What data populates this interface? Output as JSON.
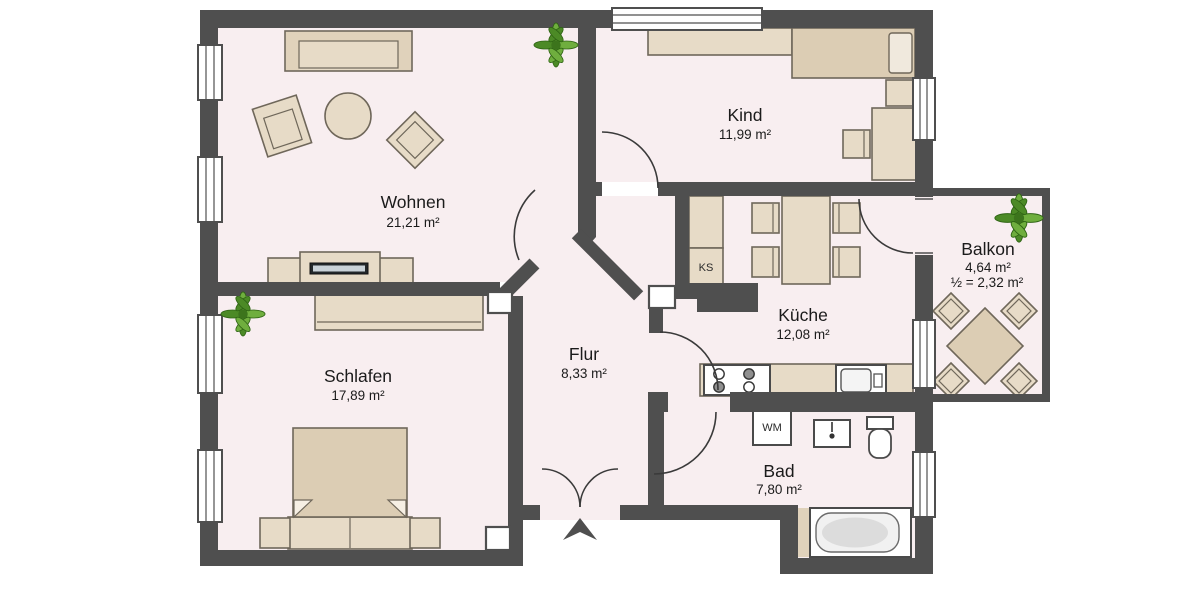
{
  "rooms": [
    {
      "id": "wohnen",
      "name": "Wohnen",
      "area": "21,21 m²"
    },
    {
      "id": "kind",
      "name": "Kind",
      "area": "11,99 m²"
    },
    {
      "id": "schlafen",
      "name": "Schlafen",
      "area": "17,89 m²"
    },
    {
      "id": "flur",
      "name": "Flur",
      "area": "8,33 m²"
    },
    {
      "id": "kueche",
      "name": "Küche",
      "area": "12,08 m²"
    },
    {
      "id": "bad",
      "name": "Bad",
      "area": "7,80 m²"
    },
    {
      "id": "balkon",
      "name": "Balkon",
      "area": "4,64 m²",
      "area_half": "½ = 2,32 m²"
    }
  ],
  "labels": {
    "fridge": "KS",
    "washing_machine": "WM"
  },
  "colors": {
    "wall": "#4f4f4f",
    "floor": "#f8eef0",
    "furniture": "#e7dbc7",
    "furniture_dark": "#dccdb4",
    "furniture_border": "#6f675a",
    "plant_green": "#6fae3e",
    "background": "#ffffff"
  }
}
